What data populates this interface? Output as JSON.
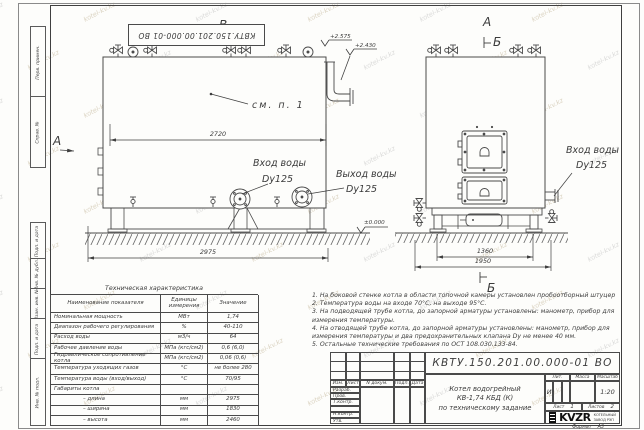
{
  "sheet": {
    "doc_number_top": "КВТУ.150.201.00.000-01 ВО",
    "watermark_text": "kotel-kv.kz",
    "side_stamps": [
      "Перв. примен.",
      "Справ. №",
      "Подп. и дата",
      "Инв. № дубл.",
      "Взам. инв. №",
      "Подп. и дата",
      "Инв. № подл."
    ],
    "format": {
      "label": "Формат",
      "value": "А3"
    }
  },
  "drawing": {
    "markers": {
      "view_b": "В",
      "section_a_left": "А",
      "view_a_top": "А",
      "section_b_top": "Б",
      "section_b_bottom": "Б"
    },
    "elevations": {
      "valves_top": "+2.575",
      "spout": "+2.430",
      "ground": "±0.000"
    },
    "dimensions": {
      "body_width": "2720",
      "overall_length": "2975",
      "frame_width": "1360",
      "overall_width": "1950"
    },
    "callouts": {
      "see_note": "см. п. 1",
      "inlet_side": {
        "title": "Вход воды",
        "size": "Dy125"
      },
      "outlet_side": {
        "title": "Выход воды",
        "size": "Dy125"
      },
      "inlet_front": {
        "title": "Вход воды",
        "size": "Dy125"
      }
    }
  },
  "spec_table": {
    "title": "Техническая характеристика",
    "col_headers": [
      "Наименование показателя",
      "Единицы измерения",
      "Значение"
    ],
    "rows": [
      {
        "name": "Номинальная мощность",
        "unit": "МВт",
        "value": "1,74"
      },
      {
        "name": "Диапазон рабочего регулирования",
        "unit": "%",
        "value": "40-110"
      },
      {
        "name": "Расход воды",
        "unit": "м3/ч",
        "value": "64"
      },
      {
        "name": "Рабочее давление воды",
        "unit": "МПа (кгс/см2)",
        "value": "0,6 (6,0)"
      },
      {
        "name": "Гидравлическое сопротивление котла",
        "unit": "МПа (кгс/см2)",
        "value": "0,06 (0,6)"
      },
      {
        "name": "Температура уходящих газов",
        "unit": "°С",
        "value": "не более 280"
      },
      {
        "name": "Температура воды (вход/выход)",
        "unit": "°С",
        "value": "70/95"
      },
      {
        "name": "Габариты котла",
        "unit": "",
        "value": ""
      },
      {
        "name": "– длина",
        "unit": "мм",
        "value": "2975"
      },
      {
        "name": "– ширина",
        "unit": "мм",
        "value": "1830"
      },
      {
        "name": "– высота",
        "unit": "мм",
        "value": "2460"
      }
    ]
  },
  "notes": [
    "1.  На боковой стенке котла в области топочной камеры установлен пробоотборный штуцер",
    "2.  Температура воды на входе 70°С, на выходе 95°С.",
    "3.  На подводящей трубе котла, до запорной арматуры установлены: манометр, прибор для измерения температуры.",
    "4.  На отводящей трубе котла, до запорной арматуры установлены: манометр, прибор для измерения температуры и два предохранительных клапана Dу не менее 40 мм.",
    "5.  Остальные технические требования по ОСТ 108.030.133-84."
  ],
  "title_block": {
    "doc_number": "КВТУ.150.201.00.000-01 ВО",
    "product": [
      "Котел водогрейный",
      "КВ-1,74 КБД (К)",
      "по техническому задание"
    ],
    "change_header": [
      "Изм.",
      "Лист",
      "N докум.",
      "Подп.",
      "Дата"
    ],
    "role_rows": [
      "Разраб.",
      "Пров.",
      "Т.контр.",
      "",
      "Н.контр.",
      "Утв."
    ],
    "lit": {
      "label": "Лит.",
      "value": "И"
    },
    "mass": {
      "label": "Масса",
      "value": ""
    },
    "scale": {
      "label": "Масштаб",
      "value": "1:20"
    },
    "sheet_no": {
      "label": "Лист",
      "value": "1"
    },
    "sheets_total": {
      "label": "Листов",
      "value": "2"
    },
    "logo": {
      "name": "KVZR",
      "sub1": "КОТЕЛЬНЫЙ",
      "sub2": "ЗАВОД РЭП"
    }
  }
}
